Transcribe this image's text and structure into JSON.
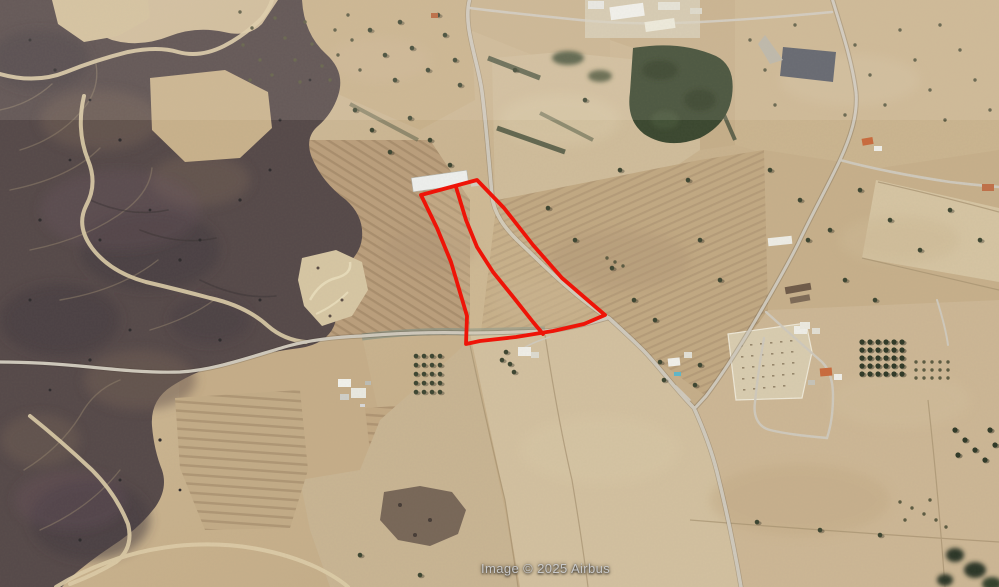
{
  "map": {
    "view": "aerial-satellite-oblique",
    "attribution": "Image © 2025 Airbus",
    "colors": {
      "highlight-red": "#ee1408",
      "attribution-gray": "#c9c9c9",
      "field-tan": "#c8b28e",
      "scrub-dark": "#554949",
      "road-gray": "#cfc9bc",
      "tree-green": "#3c4531"
    },
    "highlight": {
      "label": "parcel-boundary-overlay",
      "outer_points": "421,195 477,180 504,208 533,245 562,278 591,303 605,315 584,324 553,331 516,337 480,341 466,344 467,316 451,262 437,228",
      "divider_points": "456,187 466,220 477,247 493,272 514,298 533,322 543,334"
    }
  }
}
